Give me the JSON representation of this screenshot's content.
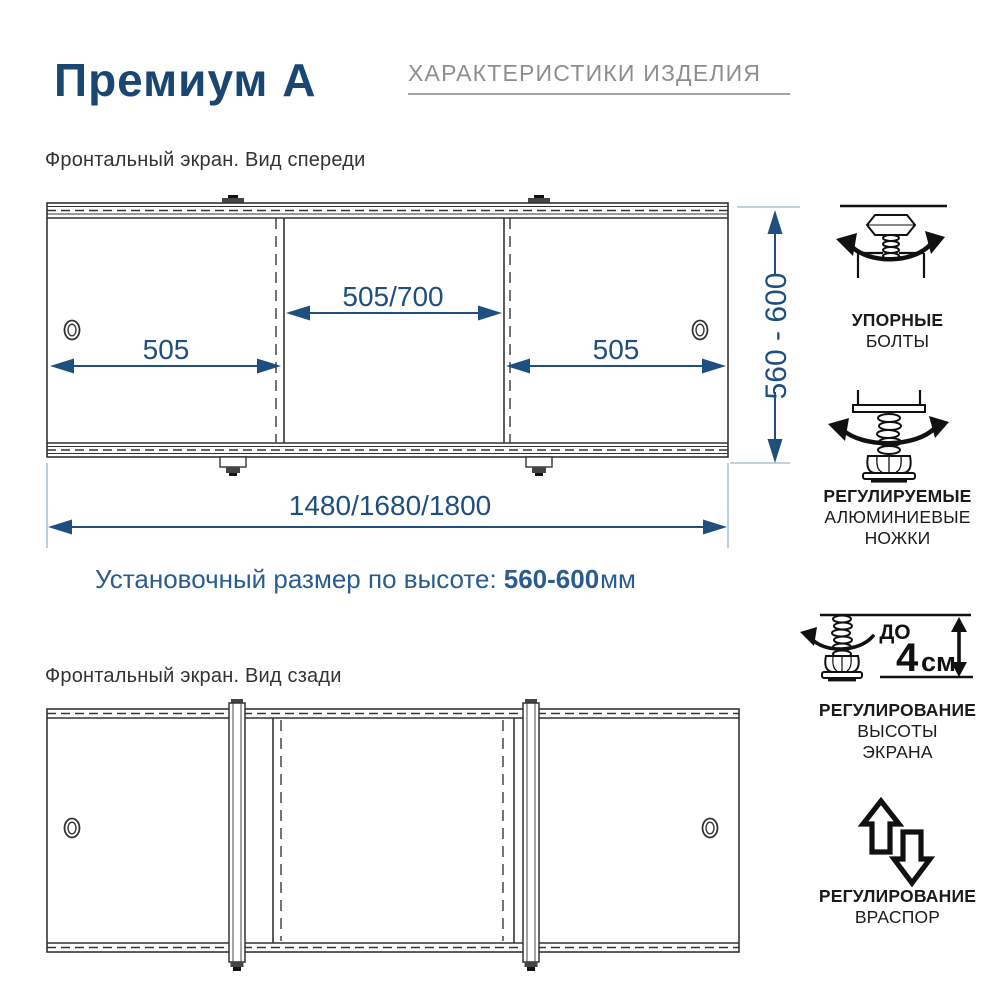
{
  "header": {
    "title": "Премиум А",
    "subtitle": "ХАРАКТЕРИСТИКИ ИЗДЕЛИЯ"
  },
  "front_view": {
    "label": "Фронтальный экран. Вид спереди",
    "dim_center": "505/700",
    "dim_left": "505",
    "dim_right": "505",
    "dim_height": "560 - 600",
    "dim_total": "1480/1680/1800"
  },
  "install_note": {
    "prefix": "Установочный размер по высоте:",
    "value": "560-600",
    "unit": "мм"
  },
  "rear_view": {
    "label": "Фронтальный экран. Вид сзади"
  },
  "sidebar": {
    "items": [
      {
        "icon": "stop-bolt-icon",
        "line1": "УПОРНЫЕ",
        "line2": "БОЛТЫ"
      },
      {
        "icon": "adjustable-foot-icon",
        "line1": "РЕГУЛИРУЕМЫЕ",
        "line2": "АЛЮМИНИЕВЫЕ",
        "line3": "НОЖКИ"
      },
      {
        "icon": "height-adjustment-icon",
        "badge_prefix": "ДО",
        "badge_value": "4",
        "badge_unit": "см",
        "line1": "РЕГУЛИРОВАНИЕ",
        "line2": "ВЫСОТЫ",
        "line3": "ЭКРАНА"
      },
      {
        "icon": "expansion-arrows-icon",
        "line1": "РЕГУЛИРОВАНИЕ",
        "line2": "ВРАСПОР"
      }
    ]
  },
  "colors": {
    "title_navy": "#1a4672",
    "dimension_blue": "#1e4f7e",
    "extension_blue": "#a9c3da",
    "note_blue": "#2a5c8f",
    "header_gray": "#8e8e8e",
    "line_dark": "#333333",
    "icon_black": "#111111"
  }
}
